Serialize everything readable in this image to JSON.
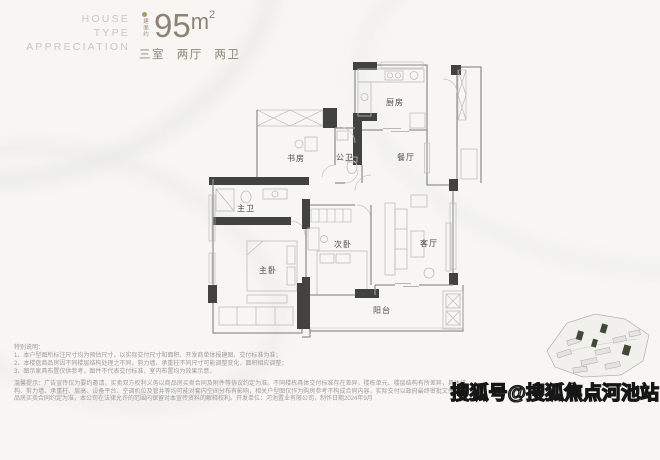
{
  "header": {
    "brand_lines": [
      "HOUSE",
      "TYPE",
      "APPRECIATION"
    ],
    "area_label_vertical": "建面约",
    "area_value": "95",
    "area_unit_base": "m",
    "area_unit_sup": "2",
    "layout_summary": "三室 两厅 两卫",
    "accent_color": "#8d8374",
    "brand_color": "#c8c7c4",
    "dot_color": "#a89c63"
  },
  "floorplan": {
    "wall_dark_color": "#424240",
    "wall_line_color": "#939391",
    "rooms": [
      {
        "id": "kitchen",
        "label": "厨房"
      },
      {
        "id": "dining",
        "label": "餐厅"
      },
      {
        "id": "public-bath",
        "label": "公卫"
      },
      {
        "id": "study",
        "label": "书房"
      },
      {
        "id": "master-bath",
        "label": "主卫"
      },
      {
        "id": "master-bedroom",
        "label": "主卧"
      },
      {
        "id": "second-bedroom",
        "label": "次卧"
      },
      {
        "id": "living-room",
        "label": "客厅"
      },
      {
        "id": "balcony",
        "label": "阳台"
      }
    ]
  },
  "disclaimer": {
    "title": "特别说明：",
    "items": [
      "1、本户型图所标注尺寸均为预估尺寸，以实际交付尺寸和面积、开发商单体报建图、交付标准为准；",
      "2、本楼盘商品房因不同楼层结构处理之不同，剪力墙、承重柱不同尺寸可能调整变化，面积相应调整；",
      "3、图示家具布置仅供参考，图件不代表交付标准，室内布置均为效果示意。"
    ],
    "notice": "温馨提示：广告宣传仅为要约邀请，买卖双方权利义务以商品房买卖合同及附件等协议约定为准。不同楼栋具体交付标准存在差异，楼栋单元、楼层结构有所差异，具体结构、剪力墙、承重柱、层高、设备平台、空调机位及管井等均可能对套内空间分布有影响，相关户型图仅作为购房参考不构成合同内容，实际交付以政府最终审批文件及商品房买卖合同约定为准，本公司在法律允许的范围内保留对本宣传资料的解释权利。开发单位：河池置业有限公司，制作日期2024年9月"
  },
  "siteplan": {
    "highlight_color": "#3e4a36"
  },
  "watermark": {
    "text": "搜狐号@搜狐焦点河池站"
  }
}
